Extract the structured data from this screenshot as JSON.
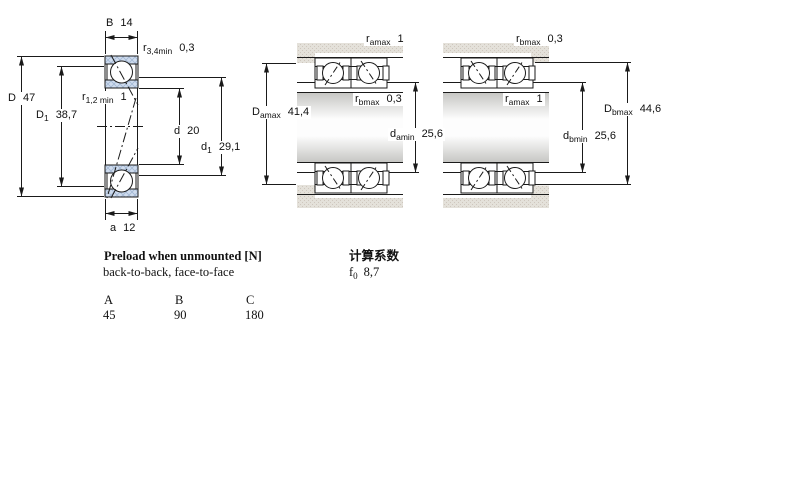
{
  "colors": {
    "line": "#1a1a1a",
    "bearing_fill": "#cfdcee",
    "bearing_hatch": "#a3b8d4",
    "housing_fill": "#e4e1da",
    "housing_dot": "#cfc7be"
  },
  "diagrams": {
    "single_bearing": {
      "dims": {
        "B": {
          "sym": "B",
          "value": "14"
        },
        "r34": {
          "sym": "r",
          "sub": "3,4min",
          "value": "0,3"
        },
        "D": {
          "sym": "D",
          "value": "47"
        },
        "D1": {
          "sym": "D",
          "sub": "1",
          "value": "38,7"
        },
        "r12": {
          "sym": "r",
          "sub": "1,2 min",
          "value": "1"
        },
        "d": {
          "sym": "d",
          "value": "20"
        },
        "d1": {
          "sym": "d",
          "sub": "1",
          "value": "29,1"
        },
        "a": {
          "sym": "a",
          "value": "12"
        }
      }
    },
    "back_to_back": {
      "dims": {
        "r_amax": {
          "sym": "r",
          "sub": "amax",
          "value": "1"
        },
        "r_bmax": {
          "sym": "r",
          "sub": "bmax",
          "value": "0,3"
        },
        "D_amax": {
          "sym": "D",
          "sub": "amax",
          "value": "41,4"
        },
        "d_amin": {
          "sym": "d",
          "sub": "amin",
          "value": "25,6"
        }
      }
    },
    "face_to_face": {
      "dims": {
        "r_bmax": {
          "sym": "r",
          "sub": "bmax",
          "value": "0,3"
        },
        "r_amax": {
          "sym": "r",
          "sub": "amax",
          "value": "1"
        },
        "D_bmax": {
          "sym": "D",
          "sub": "bmax",
          "value": "44,6"
        },
        "d_bmin": {
          "sym": "d",
          "sub": "bmin",
          "value": "25,6"
        }
      }
    }
  },
  "preload": {
    "title": "Preload when unmounted [N]",
    "subtitle": "back-to-back, face-to-face",
    "table": {
      "headers": [
        "A",
        "B",
        "C"
      ],
      "values": [
        "45",
        "90",
        "180"
      ]
    }
  },
  "calculation": {
    "title": "计算系数",
    "f0": {
      "sym": "f",
      "sub": "0",
      "value": "8,7"
    }
  }
}
